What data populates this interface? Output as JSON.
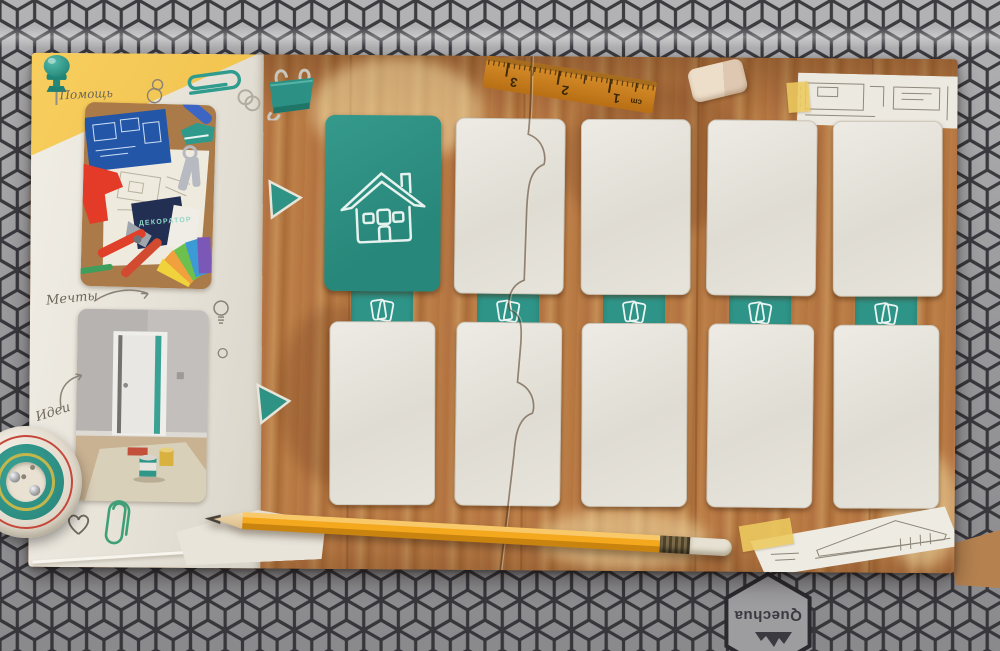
{
  "fabric": {
    "brand": "Quechua",
    "base_color": "#97979a",
    "line_color": "#2a2a2f"
  },
  "labels": {
    "help": "Помощь",
    "dreams": "Мечты",
    "ideas": "Идеи"
  },
  "photo1": {
    "brand": "ДЕКОРАТОР"
  },
  "ruler": {
    "numbers": [
      "3",
      "2",
      "1"
    ],
    "unit": "cm"
  },
  "board": {
    "accent_teal": "#2d9183",
    "wood_color": "#b5753f",
    "card_color": "#e6e3da",
    "paper_color": "#e9e5dc",
    "pencil_color": "#f2a81c",
    "slot_columns": 5,
    "slot_rows": 2
  },
  "icons": [
    "pushpin-icon",
    "paperclip-icon",
    "wire-clip-icon",
    "binder-clip-icon",
    "house-icon",
    "cards-icon",
    "play-triangle-icon",
    "lightbulb-icon",
    "heart-icon",
    "mountain-logo-icon",
    "pencil",
    "ruler",
    "eraser"
  ]
}
